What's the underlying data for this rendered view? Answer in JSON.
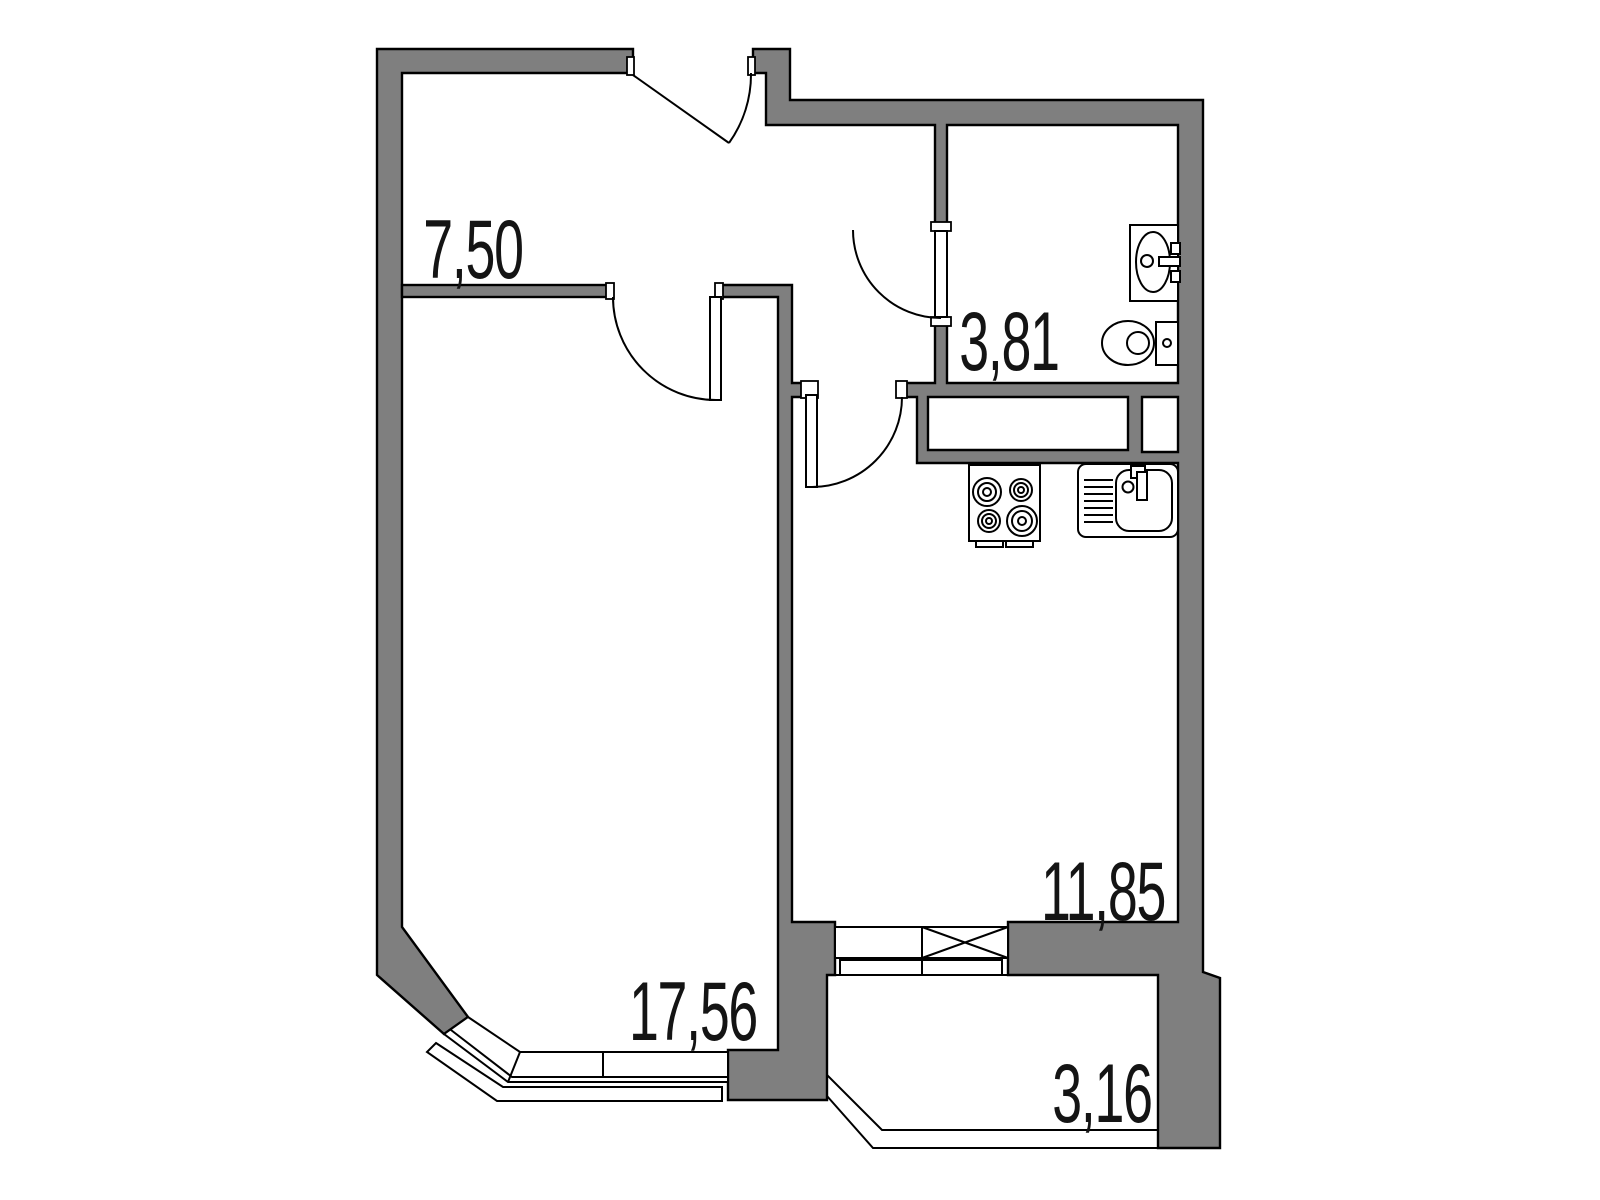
{
  "plan": {
    "type": "apartment-floor-plan",
    "units": "square-meters",
    "colors": {
      "wall_fill": "#7f7f7f",
      "line": "#000000",
      "background": "#ffffff"
    },
    "rooms": {
      "hallway": {
        "area": "7,50"
      },
      "bathroom": {
        "area": "3,81"
      },
      "kitchen": {
        "area": "11,85"
      },
      "living_room": {
        "area": "17,56"
      },
      "balcony": {
        "area": "3,16"
      }
    },
    "fixtures": [
      "bathroom-washbasin",
      "toilet",
      "stove-4-burners",
      "kitchen-sink",
      "entrance-door",
      "living-room-door",
      "kitchen-door",
      "bathroom-door",
      "balcony-door",
      "balcony-window",
      "bay-window",
      "ventilation-shafts"
    ]
  }
}
